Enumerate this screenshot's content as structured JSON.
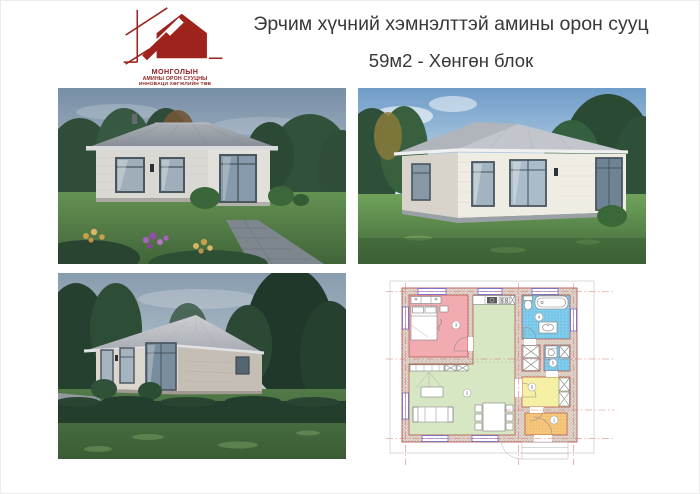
{
  "logo": {
    "line1": "МОНГОЛЫН",
    "line2": "АМИНЫ ОРОН СУУЦНЫ",
    "line3": "ИННОВАЦИ ХӨГЖЛИЙН ТӨВ"
  },
  "header": {
    "title": "Эрчим хүчний хэмнэлттэй амины орон сууц",
    "subtitle": "59м2 - Хөнгөн блок"
  },
  "gallery": {
    "items": [
      {
        "name": "exterior-front-render"
      },
      {
        "name": "exterior-corner-render"
      },
      {
        "name": "exterior-side-render"
      },
      {
        "name": "floor-plan-drawing"
      }
    ]
  },
  "floor_plan": {
    "rooms": [
      {
        "number": "1",
        "color": "#f6c87c"
      },
      {
        "number": "2",
        "color": "#d7e6c3"
      },
      {
        "number": "3",
        "color": "#f2abb1"
      },
      {
        "number": "4",
        "color": "#74c6e8"
      },
      {
        "number": "5",
        "color": "#74c6e8"
      },
      {
        "number": "6",
        "color": "#f6f0a4"
      }
    ]
  },
  "colors": {
    "logo_red": "#8e1d1d",
    "title_text": "#383838",
    "plan_axis": "#e06060",
    "plan_wall_outline": "#b5473c",
    "roof_gray": "#9aa0a8",
    "wall_offwhite": "#e9e6df",
    "grass_green": "#5d8a4b"
  }
}
